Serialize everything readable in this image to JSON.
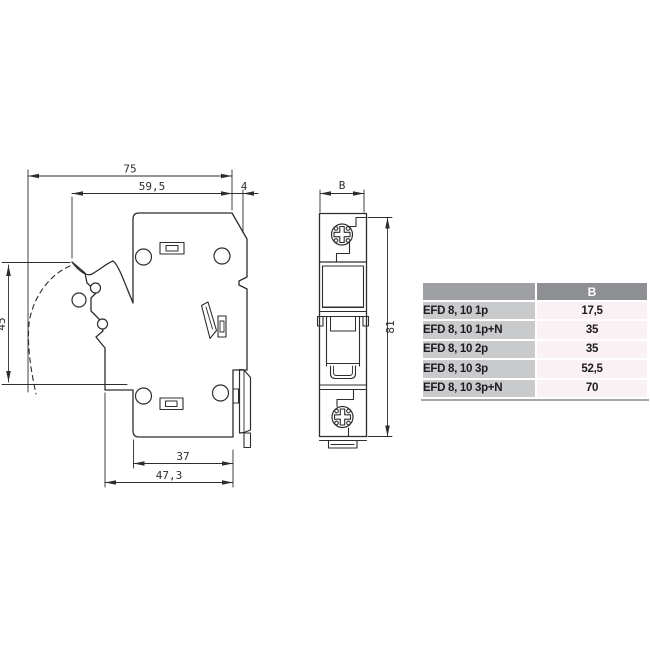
{
  "drawing": {
    "side_view": {
      "dim_total_depth": "75",
      "dim_upper_depth": "59,5",
      "dim_din_offset": "4",
      "dim_lever_swing": "45",
      "dim_base_width": "37",
      "dim_base_total_width": "47,3"
    },
    "front_view": {
      "dim_width": "B",
      "dim_height": "81"
    }
  },
  "table": {
    "col_b_header": "B",
    "rows": [
      {
        "model": "EFD 8, 10 1p",
        "b": "17,5"
      },
      {
        "model": "EFD 8, 10 1p+N",
        "b": "35"
      },
      {
        "model": "EFD 8, 10 2p",
        "b": "35"
      },
      {
        "model": "EFD 8, 10 3p",
        "b": "52,5"
      },
      {
        "model": "EFD 8, 10 3p+N",
        "b": "70"
      }
    ],
    "colors": {
      "header_bg_left": "#9ea0a3",
      "header_bg": "#8d8f92",
      "header_text": "#ffffff",
      "label_bg": "#c9cacc",
      "value_bg": "#f9f1f4",
      "text": "#1c1c1e"
    }
  }
}
